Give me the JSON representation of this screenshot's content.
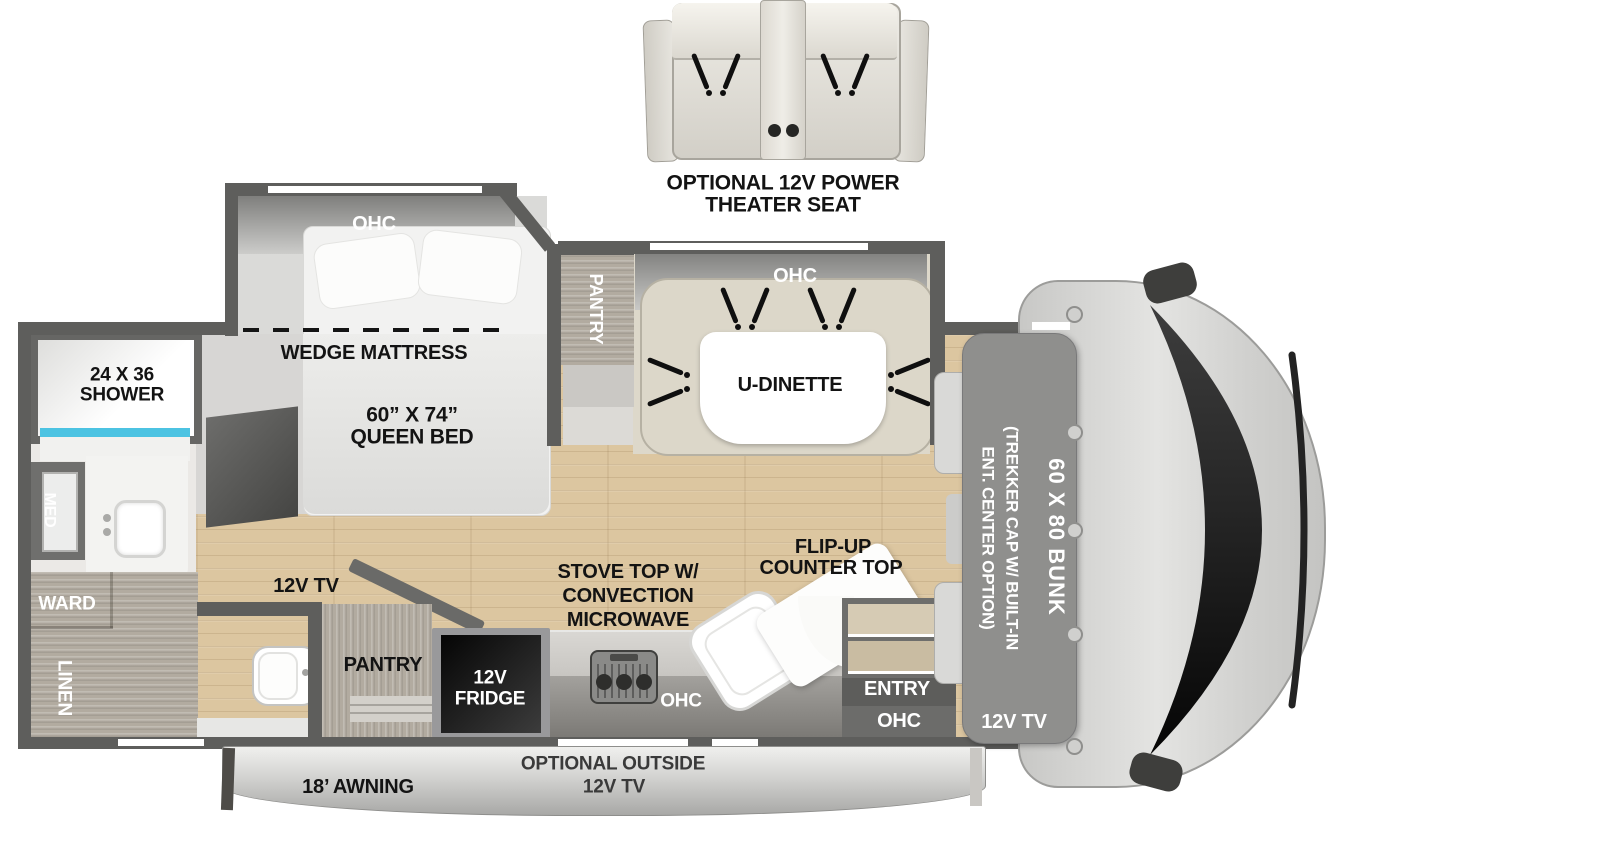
{
  "theater_seat": {
    "line1": "OPTIONAL 12V POWER",
    "line2": "THEATER SEAT"
  },
  "bedroom": {
    "ohc": "OHC",
    "wedge_label": "WEDGE MATTRESS",
    "bed_size": "60” X 74”",
    "bed_type": "QUEEN BED",
    "tv": "12V TV"
  },
  "bathroom": {
    "shower_size": "24 X 36",
    "shower": "SHOWER",
    "med": "MED",
    "ward": "WARD",
    "linen": "LINEN"
  },
  "dinette": {
    "ohc": "OHC",
    "label": "U-DINETTE",
    "pantry": "PANTRY"
  },
  "kitchen": {
    "pantry": "PANTRY",
    "fridge_line1": "12V",
    "fridge_line2": "FRIDGE",
    "stove_line1": "STOVE TOP W/",
    "stove_line2": "CONVECTION",
    "stove_line3": "MICROWAVE",
    "flip_line1": "FLIP-UP",
    "flip_line2": "COUNTER TOP",
    "ohc": "OHC"
  },
  "entry": {
    "label": "ENTRY",
    "ohc": "OHC"
  },
  "cab": {
    "cap_note_line1": "(TREKKER CAP W/ BUILT-IN",
    "cap_note_line2": "ENT. CENTER OPTION)",
    "bunk": "60 X 80 BUNK",
    "tv": "12V TV"
  },
  "exterior": {
    "awning": "18’ AWNING",
    "outside_tv_line1": "OPTIONAL OUTSIDE",
    "outside_tv_line2": "12V TV"
  },
  "colors": {
    "wall": "#5e5e5c",
    "wood_floor": "#dcc6a0",
    "shower_water": "#4cc3e2",
    "windshield": "#141414",
    "cab_body": "#d6d6d4"
  }
}
